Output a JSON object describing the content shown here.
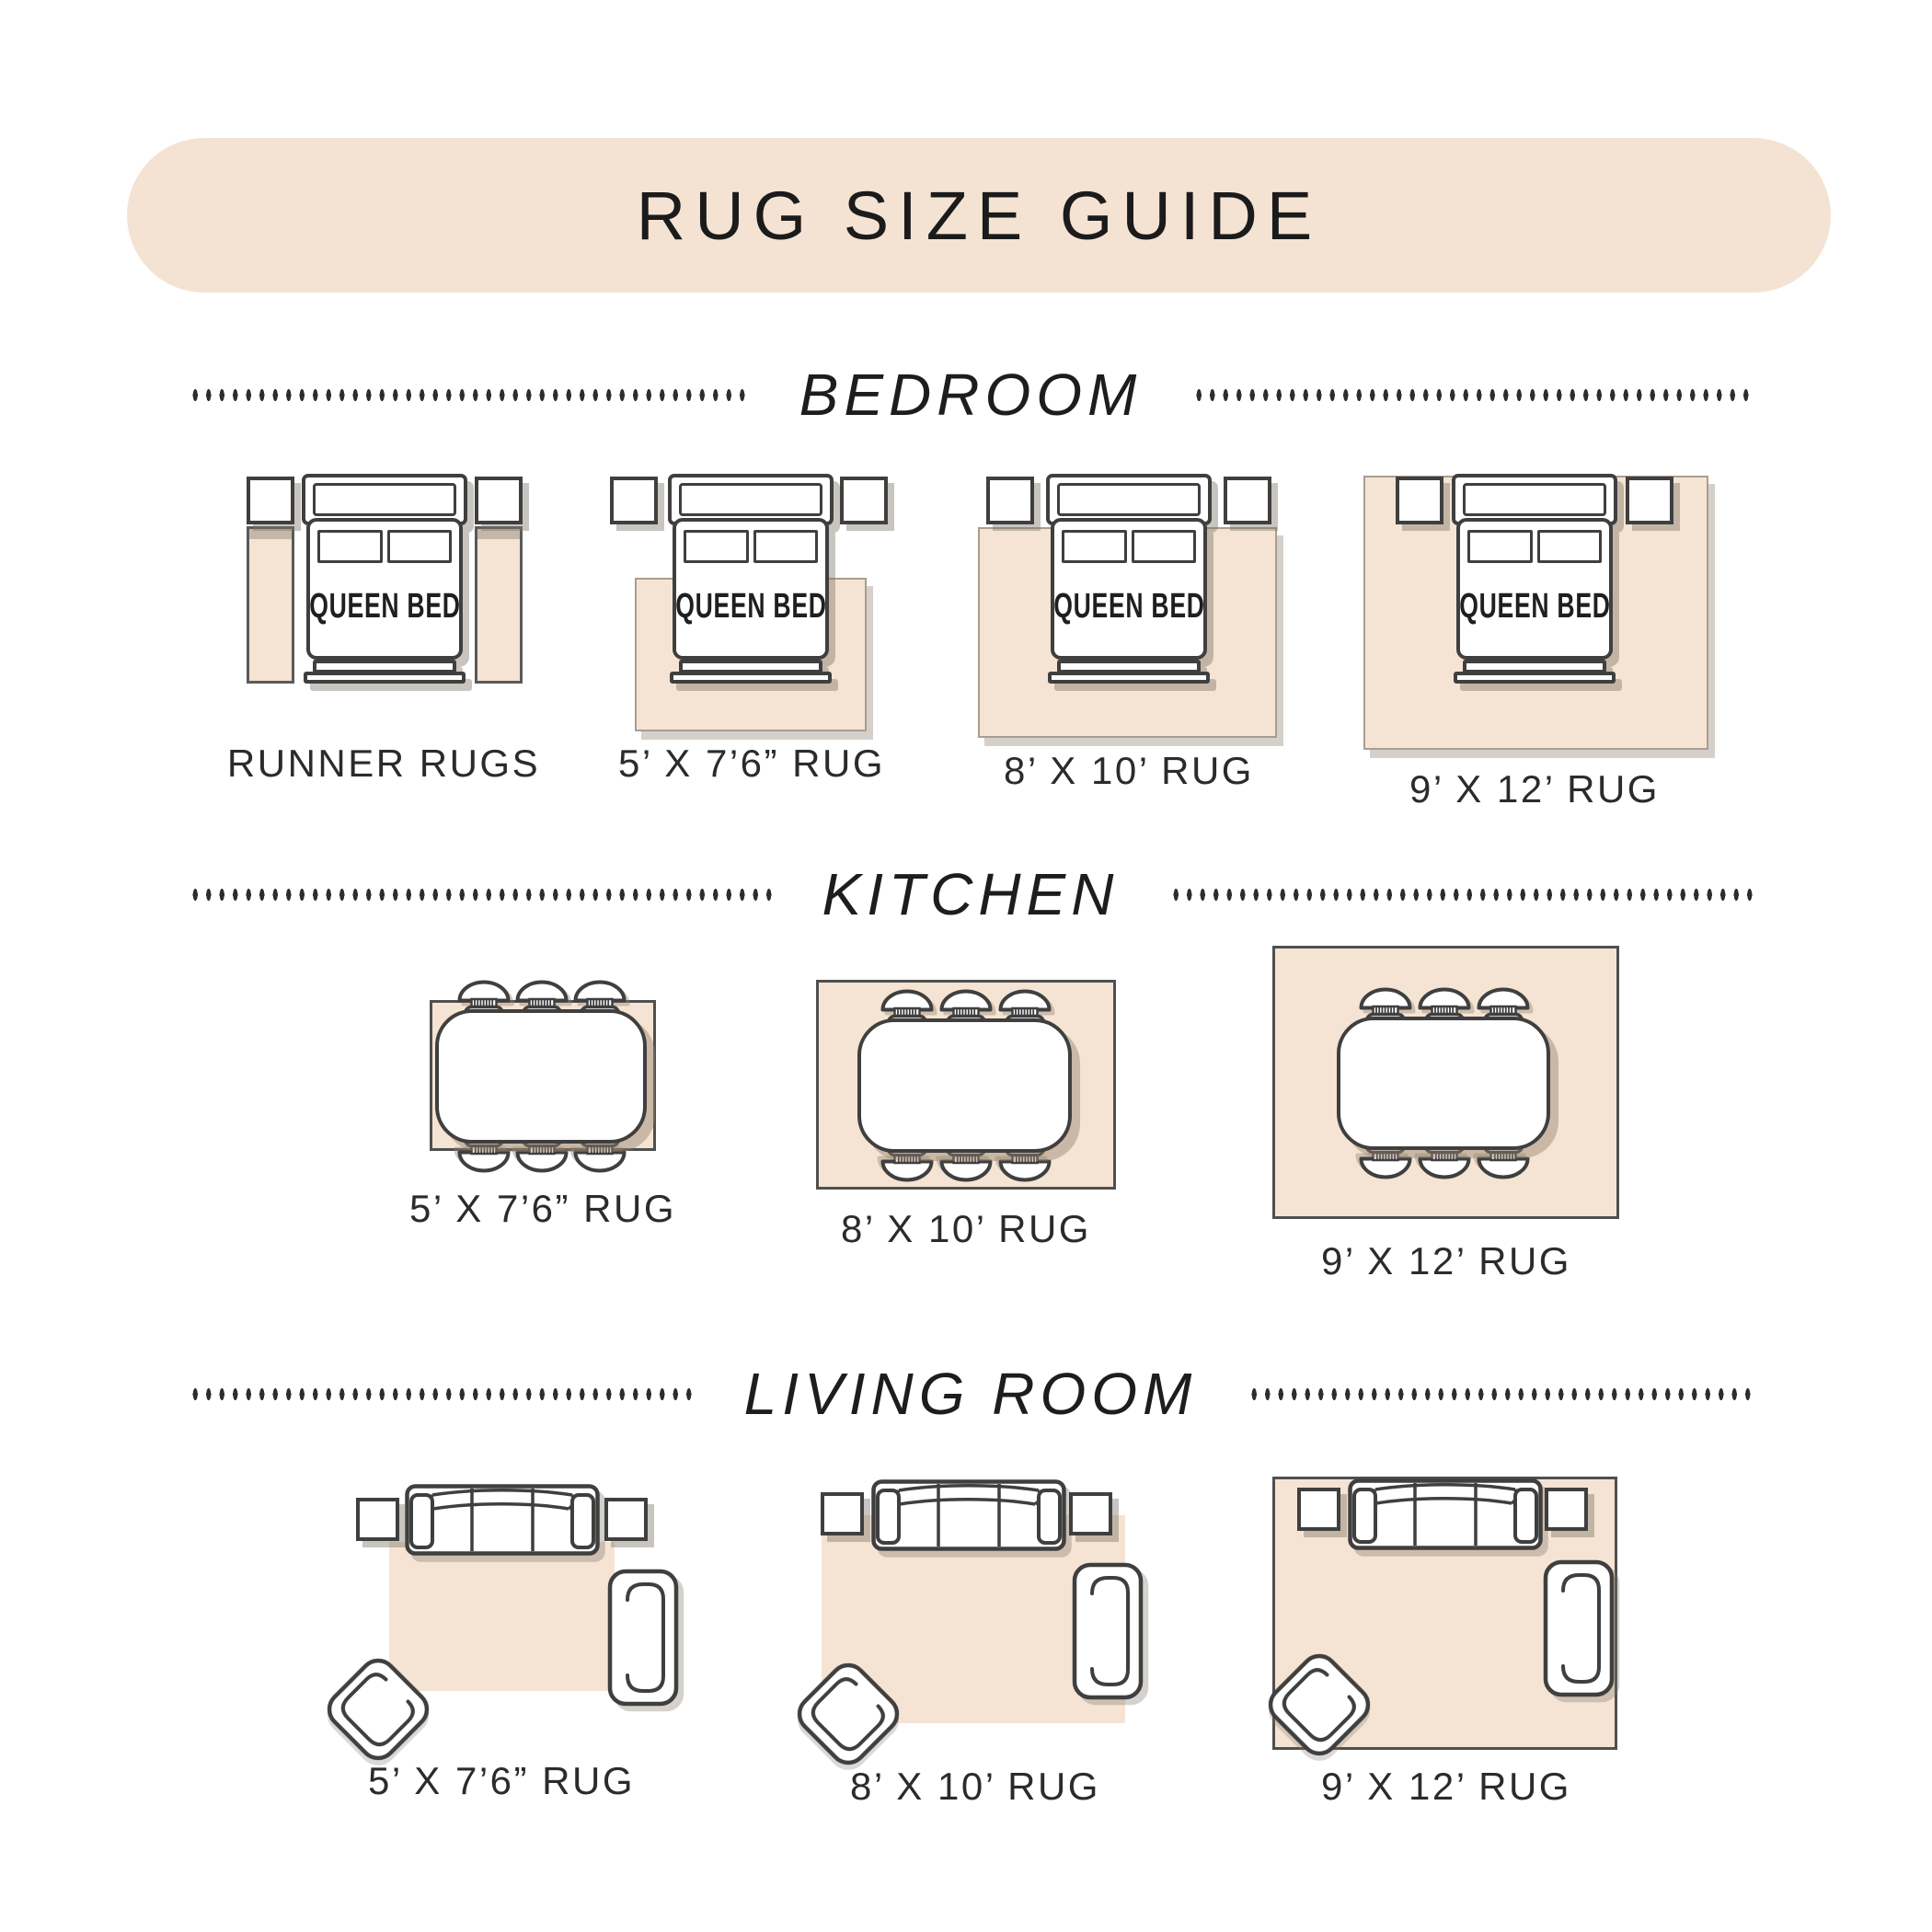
{
  "title": "RUG SIZE GUIDE",
  "bed_label": "QUEEN BED",
  "sections": [
    {
      "id": "bedroom",
      "heading": "BEDROOM",
      "labels": [
        "RUNNER RUGS",
        "5’ X 7’6” RUG",
        "8’ X 10’ RUG",
        "9’ X 12’ RUG"
      ]
    },
    {
      "id": "kitchen",
      "heading": "KITCHEN",
      "labels": [
        "5’ X 7’6” RUG",
        "8’ X 10’ RUG",
        "9’ X 12’ RUG"
      ]
    },
    {
      "id": "living-room",
      "heading": "LIVING ROOM",
      "labels": [
        "5’ X 7’6” RUG",
        "8’ X 10’ RUG",
        "9’ X 12’ RUG"
      ]
    }
  ],
  "icons": {
    "bed": "queen-bed-top-view-icon",
    "nightstand": "nightstand-icon",
    "runner_rug": "runner-rug-icon",
    "dining_table": "dining-table-icon",
    "dining_chair": "dining-chair-icon",
    "sofa": "sofa-top-view-icon",
    "armchair": "armchair-icon",
    "accent_chair": "accent-chair-icon"
  },
  "colors": {
    "banner_background": "#f4e3d3",
    "rug_beige": "#f5e4d3",
    "furniture_outline": "#3f3f3f",
    "text_dark": "#1d1d1d",
    "shadow_gray": "#b3a89d"
  }
}
